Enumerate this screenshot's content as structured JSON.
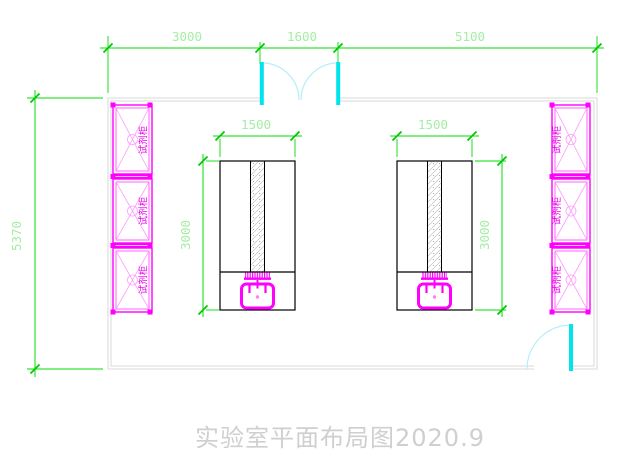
{
  "drawing": {
    "title": "实验室平面布局图2020.9",
    "dims": {
      "top1": "3000",
      "top2": "1600",
      "top3": "5100",
      "room_height": "5370",
      "bench_width": "1500",
      "bench_depth": "3000"
    },
    "cabinet_label": "试剂柜",
    "colors": {
      "dimension_line": "#00dd00",
      "dimension_text": "#a5eca5",
      "furniture_magenta": "#ff00ff",
      "door_cyan": "#00e4ee",
      "door_arc": "#b5eef8",
      "wall_gray": "#d8d8d8",
      "bench_outline": "#000000",
      "title_text": "#cfcfcf"
    }
  }
}
